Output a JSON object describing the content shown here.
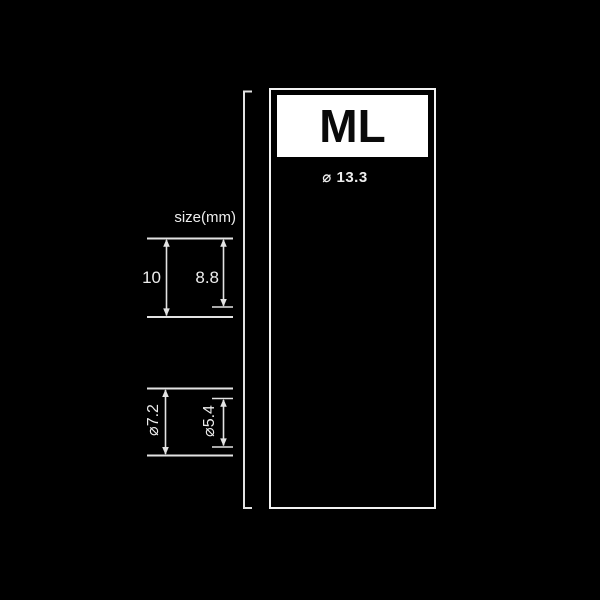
{
  "header": {
    "size_code": "ML"
  },
  "spec": {
    "unit_label": "size(mm)",
    "top_diameter_label": "⌀ 13.3",
    "total_height_label": "10",
    "dome_height_label": "8.8",
    "core_outer_diameter_label": "⌀7.2",
    "core_inner_diameter_label": "⌀5.4"
  },
  "colors": {
    "background": "#000000",
    "dimension_line": "#e3e3e3",
    "drawing_line": "#d6d6d6",
    "panel_border": "#f2f2f2",
    "plate_background": "#ffffff",
    "plate_text": "#0a0a0a",
    "label_text": "#ededed"
  }
}
